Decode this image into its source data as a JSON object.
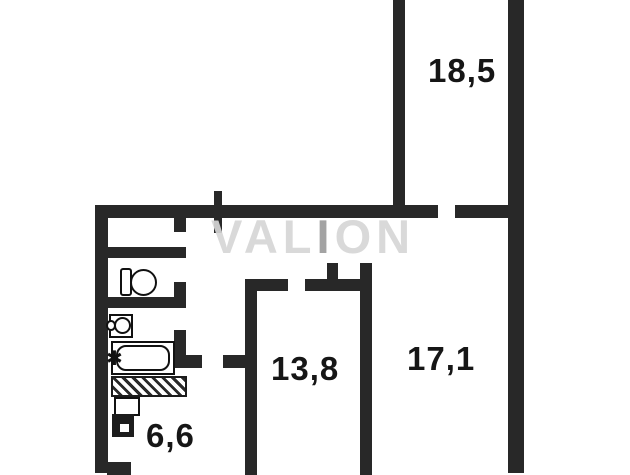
{
  "plan": {
    "title": "apartment-floor-plan",
    "watermark": {
      "part1": "VAL",
      "part2": "I",
      "part3": "ON"
    },
    "rooms": [
      {
        "id": "room-top",
        "area": "18,5"
      },
      {
        "id": "room-middle",
        "area": "13,8"
      },
      {
        "id": "room-right",
        "area": "17,1"
      },
      {
        "id": "kitchen",
        "area": "6,6"
      }
    ],
    "fixtures": {
      "toilet": "toilet-top-view",
      "sink": "washbasin-top-view",
      "bathtub": "bathtub-top-view",
      "vent_shaft": "hatched-duct-block",
      "heater": "water-heater-unit",
      "tap_glyph": "✱"
    },
    "colors": {
      "wall": "#282828",
      "label": "#161616",
      "watermark_light": "#d6d6d6",
      "watermark_dark": "#9c9c9c",
      "background": "#ffffff"
    }
  }
}
